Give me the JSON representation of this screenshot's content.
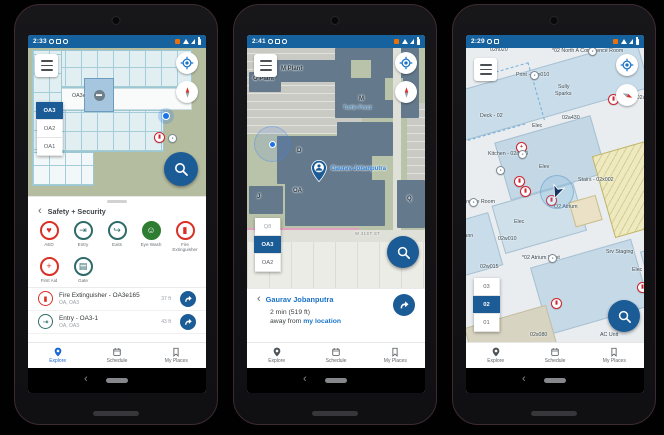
{
  "ui_colors": {
    "primary_blue": "#1b5c97",
    "status_blue": "#16629e",
    "link_blue": "#1a73c9",
    "explore_active": "#1967d2",
    "marker_red": "#cf2430",
    "teal": "#2e6b68",
    "green": "#2e7d32"
  },
  "phones": [
    {
      "status": {
        "time": "2:33"
      },
      "map": {
        "labels": [
          {
            "text": "OA3e",
            "x": 44,
            "y": 46
          }
        ],
        "markers": [
          {
            "glyph": "▮",
            "cls": "red",
            "x": 126,
            "y": 84
          },
          {
            "glyph": "●",
            "cls": "gray",
            "x": 140,
            "y": 86
          }
        ],
        "floors": [
          {
            "label": "OA3",
            "selected": true
          },
          {
            "label": "OA2"
          },
          {
            "label": "OA1"
          }
        ]
      },
      "sheet": {
        "title": "Safety + Security",
        "categories": [
          {
            "label": "AED",
            "glyph": "♥",
            "cls": "red"
          },
          {
            "label": "Entry",
            "glyph": "⇥",
            "cls": "teal"
          },
          {
            "label": "Exits",
            "glyph": "↪",
            "cls": "teal"
          },
          {
            "label": "Eye Wash",
            "glyph": "☺",
            "cls": "green-fill"
          },
          {
            "label": "Fire Extinguisher",
            "glyph": "▮",
            "cls": "red"
          },
          {
            "label": "First Aid",
            "glyph": "+",
            "cls": "red"
          },
          {
            "label": "Gate",
            "glyph": "▤",
            "cls": "teal"
          }
        ],
        "results": [
          {
            "title": "Fire Extinguisher - OA3e165",
            "subtitle": "OA, OA3",
            "distance": "37 ft",
            "glyph": "▮",
            "cls": "red"
          },
          {
            "title": "Entry - OA3-1",
            "subtitle": "OA, OA3",
            "distance": "43 ft",
            "glyph": "⇥",
            "cls": "teal"
          }
        ]
      },
      "nav": {
        "explore": "Explore",
        "schedule": "Schedule",
        "places": "My Places"
      }
    },
    {
      "status": {
        "time": "2:41"
      },
      "map": {
        "labels": [
          {
            "text": "M Plant",
            "x": 34,
            "y": 18,
            "cls": "bld"
          },
          {
            "text": "O Plant",
            "x": 6,
            "y": 28,
            "cls": "bld"
          },
          {
            "text": "M",
            "x": 112,
            "y": 48,
            "cls": "bld"
          },
          {
            "text": "Turtle Pond",
            "x": 96,
            "y": 58,
            "cls": "water"
          },
          {
            "text": "D",
            "x": 50,
            "y": 100,
            "cls": "bld"
          },
          {
            "text": "OA",
            "x": 46,
            "y": 140,
            "cls": "bld"
          },
          {
            "text": "Q",
            "x": 160,
            "y": 148,
            "cls": "bld"
          },
          {
            "text": "J",
            "x": 10,
            "y": 146,
            "cls": "bld"
          },
          {
            "text": "W 41ST ST",
            "x": 108,
            "y": 184,
            "cls": "road"
          }
        ],
        "pin_label": "Gaurav Jobanputra",
        "floors": [
          {
            "label": "Q8",
            "cls": "faded"
          },
          {
            "label": "OA3",
            "selected": true
          },
          {
            "label": "OA2"
          }
        ]
      },
      "sheet": {
        "title": "Gaurav Jobanputra",
        "eta": "2 min (519 ft)",
        "away_prefix": "away from",
        "link": "my location"
      },
      "nav": {
        "explore": "Explore",
        "schedule": "Schedule",
        "places": "My Places"
      }
    },
    {
      "status": {
        "time": "2:29"
      },
      "map": {
        "labels": [
          {
            "text": "02n020",
            "x": 24,
            "y": 0
          },
          {
            "text": "*02 North A Conference Room",
            "x": 86,
            "y": 1
          },
          {
            "text": "Print - 02n010",
            "x": 50,
            "y": 25
          },
          {
            "text": "Sully",
            "x": 92,
            "y": 37
          },
          {
            "text": "Sparks",
            "x": 89,
            "y": 44
          },
          {
            "text": "Men's - 02a330",
            "x": 152,
            "y": 48
          },
          {
            "text": "Deck - 02",
            "x": 14,
            "y": 66
          },
          {
            "text": "02a430",
            "x": 96,
            "y": 68
          },
          {
            "text": "Elec",
            "x": 66,
            "y": 76
          },
          {
            "text": "Kitchen - 02a510",
            "x": 22,
            "y": 104
          },
          {
            "text": "Elev",
            "x": 73,
            "y": 117
          },
          {
            "text": "Stairs - 02x002",
            "x": 112,
            "y": 130
          },
          {
            "text": "O2 Atrium",
            "x": 88,
            "y": 157
          },
          {
            "text": "Conference Room",
            "x": -14,
            "y": 152
          },
          {
            "text": "mann",
            "x": -6,
            "y": 186
          },
          {
            "text": "Elec",
            "x": 48,
            "y": 172
          },
          {
            "text": "02w010",
            "x": 32,
            "y": 189
          },
          {
            "text": "*02 Atrium West",
            "x": 56,
            "y": 208
          },
          {
            "text": "02w015",
            "x": 14,
            "y": 217
          },
          {
            "text": "Srv Staging",
            "x": 140,
            "y": 202
          },
          {
            "text": "Elec",
            "x": 166,
            "y": 220
          },
          {
            "text": "02s080",
            "x": 64,
            "y": 285
          },
          {
            "text": "AC Unit",
            "x": 134,
            "y": 285
          }
        ],
        "markers": [
          {
            "glyph": "●",
            "cls": "gray",
            "x": 122,
            "y": -1
          },
          {
            "glyph": "●",
            "cls": "gray",
            "x": 64,
            "y": 23
          },
          {
            "glyph": "▮",
            "cls": "red",
            "x": 142,
            "y": 46
          },
          {
            "glyph": "+",
            "cls": "red",
            "x": 50,
            "y": 94
          },
          {
            "glyph": "●",
            "cls": "gray",
            "x": 52,
            "y": 102
          },
          {
            "glyph": "●",
            "cls": "gray",
            "x": 30,
            "y": 118
          },
          {
            "glyph": "▮",
            "cls": "red",
            "x": 48,
            "y": 128
          },
          {
            "glyph": "▮",
            "cls": "red",
            "x": 54,
            "y": 138
          },
          {
            "glyph": "▮",
            "cls": "red",
            "x": 80,
            "y": 147
          },
          {
            "glyph": "●",
            "cls": "gray",
            "x": 3,
            "y": 150
          },
          {
            "glyph": "●",
            "cls": "gray",
            "x": 82,
            "y": 206
          },
          {
            "glyph": "▮",
            "cls": "red",
            "x": 85,
            "y": 250
          },
          {
            "glyph": "▮",
            "cls": "red",
            "x": 171,
            "y": 234
          }
        ],
        "floors": [
          {
            "label": "03"
          },
          {
            "label": "02",
            "selected": true
          },
          {
            "label": "01"
          }
        ]
      },
      "nav": {
        "explore": "Explore",
        "schedule": "Schedule",
        "places": "My Places"
      }
    }
  ]
}
